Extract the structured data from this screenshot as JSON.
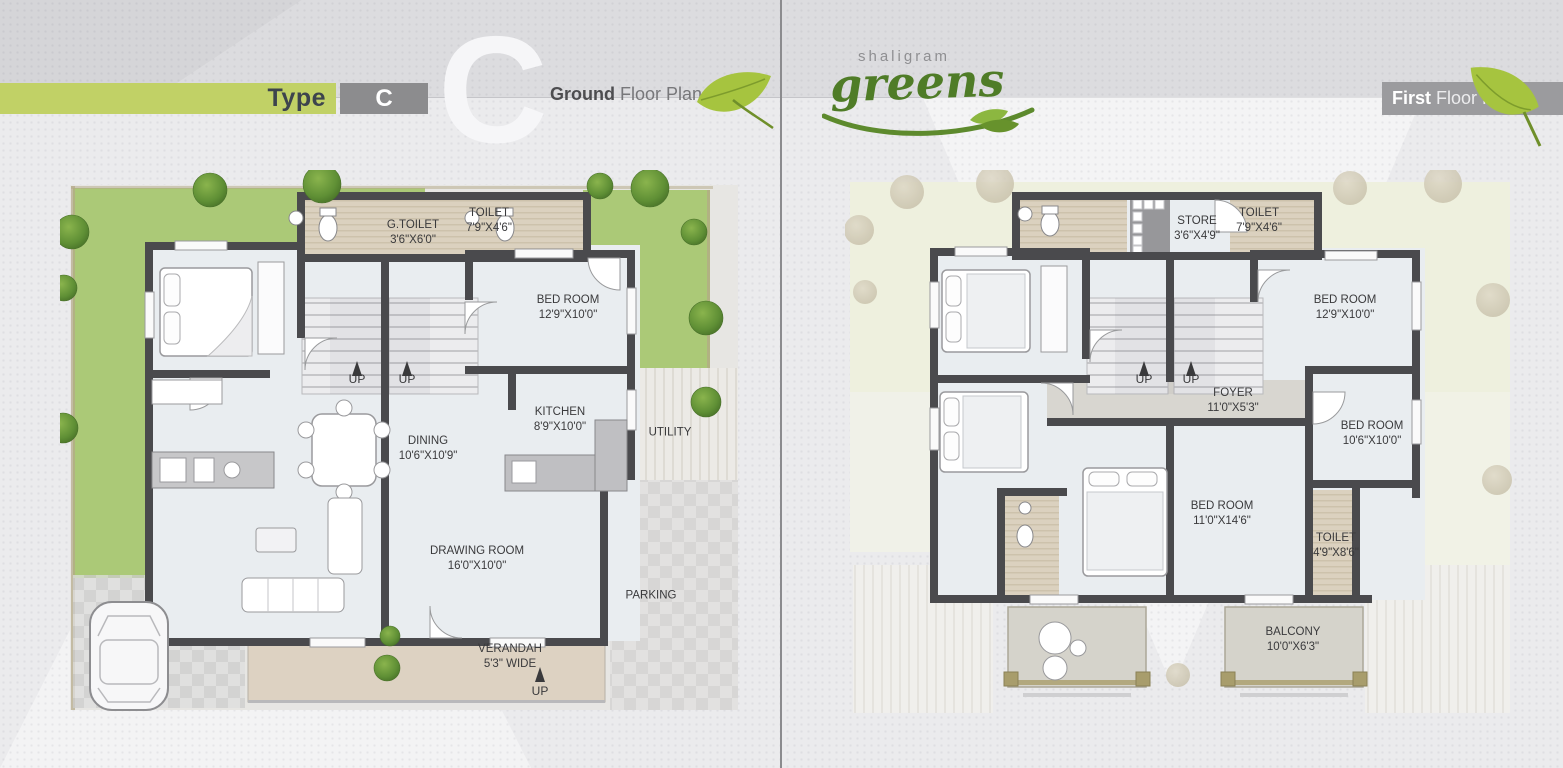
{
  "header": {
    "type_label": "Type",
    "type_code": "C",
    "watermark": "C",
    "ground_plan_bold": "Ground",
    "ground_plan_rest": " Floor Plan",
    "first_plan_bold": "First",
    "first_plan_rest": " Floor Plan",
    "brand_top": "shaligram",
    "brand_main": "greens"
  },
  "colors": {
    "accent_green": "#c1d166",
    "lawn_green": "#abc977",
    "wall_dark": "#4a4a4d",
    "leaf_green": "#a6c43f",
    "brand_green": "#4f7c27",
    "band_gray": "#9b9b9e"
  },
  "ground": {
    "g_toilet": {
      "name": "G.TOILET",
      "dims": "3'6\"X6'0\""
    },
    "toilet": {
      "name": "TOILET",
      "dims": "7'9\"X4'6\""
    },
    "bed_room": {
      "name": "BED ROOM",
      "dims": "12'9\"X10'0\""
    },
    "kitchen": {
      "name": "KITCHEN",
      "dims": "8'9\"X10'0\""
    },
    "dining": {
      "name": "DINING",
      "dims": "10'6\"X10'9\""
    },
    "utility": {
      "name": "UTILITY"
    },
    "drawing_room": {
      "name": "DRAWING ROOM",
      "dims": "16'0\"X10'0\""
    },
    "parking": {
      "name": "PARKING"
    },
    "verandah": {
      "name": "VERANDAH",
      "dims": "5'3\" WIDE"
    },
    "up": "UP"
  },
  "first": {
    "store": {
      "name": "STORE",
      "dims": "3'6\"X4'9\""
    },
    "toilet_top": {
      "name": "TOILET",
      "dims": "7'9\"X4'6\""
    },
    "bed_room_1": {
      "name": "BED ROOM",
      "dims": "12'9\"X10'0\""
    },
    "foyer": {
      "name": "FOYER",
      "dims": "11'0\"X5'3\""
    },
    "bed_room_2": {
      "name": "BED ROOM",
      "dims": "10'6\"X10'0\""
    },
    "bed_room_3": {
      "name": "BED ROOM",
      "dims": "11'0\"X14'6\""
    },
    "toilet_2": {
      "name": "TOILET",
      "dims": "4'9\"X8'6\""
    },
    "balcony": {
      "name": "BALCONY",
      "dims": "10'0\"X6'3\""
    },
    "up": "UP"
  }
}
